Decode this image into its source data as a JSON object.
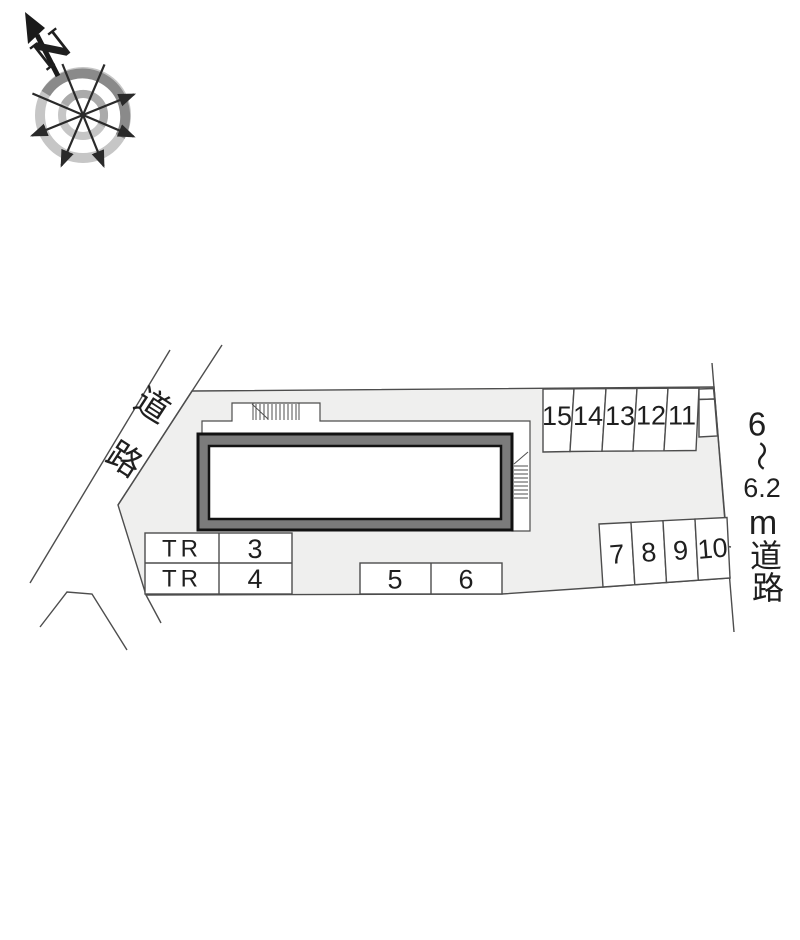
{
  "compass": {
    "north_label": "N"
  },
  "roads": {
    "left_label_chars": [
      "道",
      "路"
    ],
    "right_label_chars": [
      "6",
      "〜",
      "6.2",
      "m",
      "道",
      "路"
    ]
  },
  "parking": {
    "row_top_right": [
      "15",
      "14",
      "13",
      "12",
      "11"
    ],
    "row_bottom_right": [
      "7",
      "8",
      "9",
      "10"
    ],
    "row_middle": [
      "5",
      "6"
    ],
    "tr_rows": [
      {
        "label": "TR",
        "number": "3"
      },
      {
        "label": "TR",
        "number": "4"
      }
    ]
  },
  "colors": {
    "site_fill": "#efefee",
    "building_band": "#7b7b7b",
    "building_outline": "#121212",
    "line": "#4d4d4d",
    "compass_ring_dark": "#8a8a8a",
    "compass_ring_light": "#c6c6c6"
  }
}
